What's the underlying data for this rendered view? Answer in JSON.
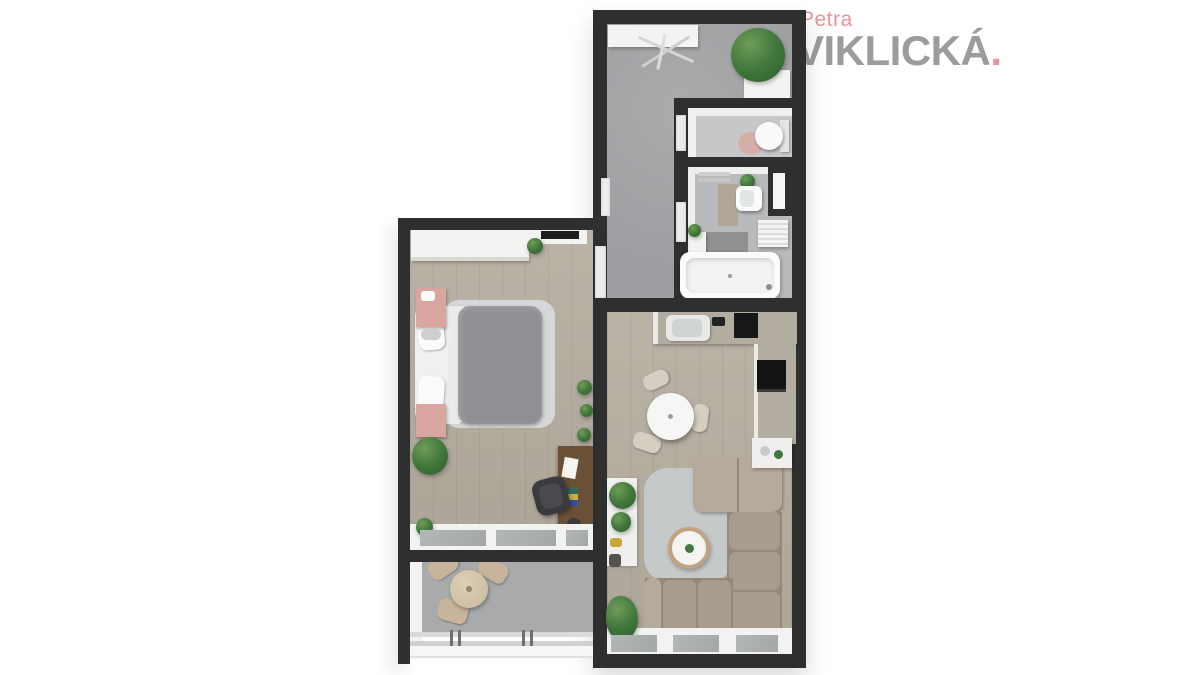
{
  "logo": {
    "first_name": "Petra",
    "last_name": "VIKLICKÁ",
    "dot": "."
  },
  "colors": {
    "bg": "#ffffff",
    "wall": "#2f2f2f",
    "logo_gray": "#9c9c9e",
    "accent_pink": "#e4959c",
    "wood_floor": "#b7aea1",
    "hall_floor": "#9d9ea1",
    "hall_floor_light": "#ababad",
    "balcony_floor": "#a8aaac",
    "bath_floor": "#b9babc",
    "wc_floor": "#c7c7c9",
    "counter": "#b3aca0",
    "sofa": "#a89c8f",
    "sofa_light": "#b6aa9c",
    "sofa_seam": "#948878",
    "rug": "#c6c9ca",
    "blanket": "#8f9094",
    "bed_platform": "#d6d7d8",
    "nightstand_pink": "#d9a7a0",
    "plant_green": "#41783c",
    "plant_green_dark": "#2e5c2e",
    "chair_beige": "#c8b49b",
    "dining_chair": "#d6cec0",
    "desk_brown": "#6b5038",
    "glass": "#b2b7b5",
    "white_furniture": "#f3f3f1"
  },
  "plan": {
    "type": "apartment-floor-plan-3d-render",
    "rooms": [
      "entry-hall",
      "wc",
      "bathroom",
      "kitchen-living-room",
      "bedroom",
      "balcony"
    ]
  }
}
